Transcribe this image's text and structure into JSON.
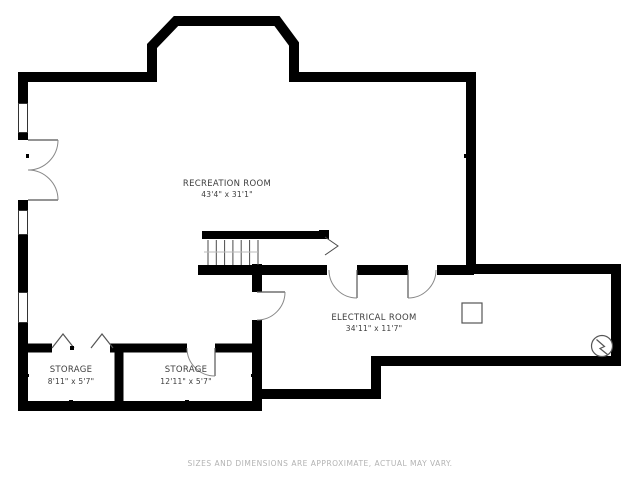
{
  "rooms": {
    "recreation": {
      "name": "RECREATION ROOM",
      "dims": "43'4\" x 31'1\""
    },
    "electrical": {
      "name": "ELECTRICAL ROOM",
      "dims": "34'11\" x 11'7\""
    },
    "storage_small": {
      "name": "STORAGE",
      "dims": "8'11\" x 5'7\""
    },
    "storage_large": {
      "name": "STORAGE",
      "dims": "12'11\" x 5'7\""
    }
  },
  "footer": {
    "disclaimer": "SIZES AND DIMENSIONS ARE APPROXIMATE, ACTUAL MAY VARY."
  },
  "colors": {
    "wall": "#000000",
    "fixture_lines": "#555555",
    "door_arc": "#888888",
    "room_label": "#3d3d3d",
    "disclaimer_text": "#b3b3b3",
    "background": "#ffffff"
  },
  "symbols": {
    "windows": "wall-window",
    "double_door": "double-swing-door",
    "single_doors": "swing-door",
    "bifold_doors": "bifold-closet-door",
    "stairs": "staircase-with-direction-chevron",
    "furnace": "square-utility-fixture",
    "electrical_panel": "circle-with-lightning-bolt"
  }
}
